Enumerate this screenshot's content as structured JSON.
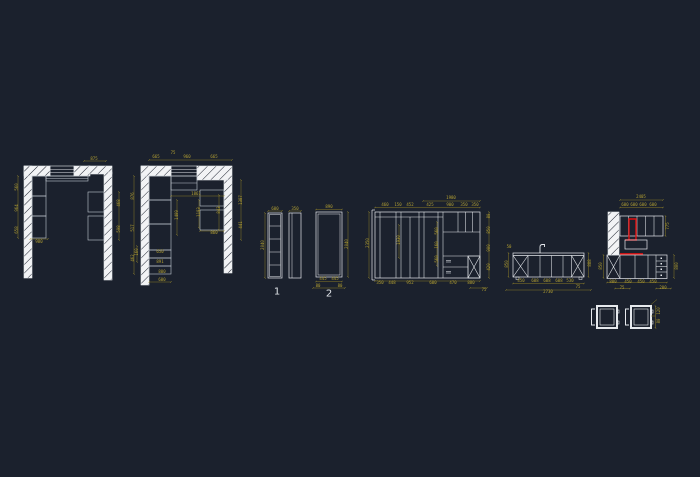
{
  "canvas": {
    "background": "#1b212d",
    "line_color": "#e6e9ed",
    "cabinet_line_color": "#c2c8d0",
    "dim_color": "#b3a032",
    "accent_red": "#e01010",
    "wall_fill": "#f2f3f5"
  },
  "view_labels": {
    "elevation_1": "1",
    "elevation_2": "2"
  },
  "dimensions": [
    {
      "x": 94,
      "y": 159,
      "t": "875"
    },
    {
      "x": 17,
      "y": 187,
      "t": "560",
      "r": -90
    },
    {
      "x": 17,
      "y": 208,
      "t": "964",
      "r": -90
    },
    {
      "x": 17,
      "y": 230,
      "t": "658",
      "r": -90
    },
    {
      "x": 39,
      "y": 242,
      "t": "980"
    },
    {
      "x": 119,
      "y": 203,
      "t": "468",
      "r": -90
    },
    {
      "x": 119,
      "y": 229,
      "t": "598",
      "r": -90
    },
    {
      "x": 156,
      "y": 157,
      "t": "665"
    },
    {
      "x": 173,
      "y": 153,
      "t": "75"
    },
    {
      "x": 187,
      "y": 157,
      "t": "960"
    },
    {
      "x": 214,
      "y": 157,
      "t": "665"
    },
    {
      "x": 133,
      "y": 196,
      "t": "876",
      "r": -90
    },
    {
      "x": 133,
      "y": 228,
      "t": "517",
      "r": -90
    },
    {
      "x": 133,
      "y": 258,
      "t": "462",
      "r": -90
    },
    {
      "x": 196,
      "y": 194,
      "t": "1861"
    },
    {
      "x": 177,
      "y": 215,
      "t": "1409",
      "r": -90
    },
    {
      "x": 199,
      "y": 212,
      "t": "1193",
      "r": -90
    },
    {
      "x": 219,
      "y": 210,
      "t": "843",
      "r": -90
    },
    {
      "x": 241,
      "y": 200,
      "t": "1387",
      "r": -90
    },
    {
      "x": 241,
      "y": 225,
      "t": "441",
      "r": -90
    },
    {
      "x": 214,
      "y": 233,
      "t": "860"
    },
    {
      "x": 160,
      "y": 252,
      "t": "650"
    },
    {
      "x": 160,
      "y": 262,
      "t": "891"
    },
    {
      "x": 162,
      "y": 272,
      "t": "800"
    },
    {
      "x": 162,
      "y": 280,
      "t": "600"
    },
    {
      "x": 137,
      "y": 252,
      "t": "160",
      "r": -90
    },
    {
      "x": 275,
      "y": 209,
      "t": "600"
    },
    {
      "x": 295,
      "y": 209,
      "t": "350"
    },
    {
      "x": 263,
      "y": 245,
      "t": "2040",
      "r": -90
    },
    {
      "x": 329,
      "y": 207,
      "t": "890"
    },
    {
      "x": 347,
      "y": 244,
      "t": "2040",
      "r": -90
    },
    {
      "x": 323,
      "y": 279,
      "t": "445"
    },
    {
      "x": 335,
      "y": 279,
      "t": "445"
    },
    {
      "x": 318,
      "y": 286,
      "t": "80"
    },
    {
      "x": 340,
      "y": 286,
      "t": "80"
    },
    {
      "x": 451,
      "y": 198,
      "t": "1980"
    },
    {
      "x": 385,
      "y": 205,
      "t": "460"
    },
    {
      "x": 398,
      "y": 205,
      "t": "150"
    },
    {
      "x": 410,
      "y": 205,
      "t": "452"
    },
    {
      "x": 430,
      "y": 205,
      "t": "425"
    },
    {
      "x": 450,
      "y": 205,
      "t": "900"
    },
    {
      "x": 464,
      "y": 205,
      "t": "350"
    },
    {
      "x": 475,
      "y": 205,
      "t": "350"
    },
    {
      "x": 368,
      "y": 243,
      "t": "2350",
      "r": -90
    },
    {
      "x": 399,
      "y": 240,
      "t": "1930",
      "r": -90
    },
    {
      "x": 437,
      "y": 231,
      "t": "560",
      "r": -90
    },
    {
      "x": 437,
      "y": 245,
      "t": "160",
      "r": -90
    },
    {
      "x": 437,
      "y": 259,
      "t": "560",
      "r": -90
    },
    {
      "x": 489,
      "y": 216,
      "t": "80",
      "r": -90
    },
    {
      "x": 489,
      "y": 230,
      "t": "850",
      "r": -90
    },
    {
      "x": 489,
      "y": 248,
      "t": "900",
      "r": -90
    },
    {
      "x": 489,
      "y": 267,
      "t": "420",
      "r": -90
    },
    {
      "x": 380,
      "y": 283,
      "t": "350"
    },
    {
      "x": 392,
      "y": 283,
      "t": "448"
    },
    {
      "x": 410,
      "y": 283,
      "t": "952"
    },
    {
      "x": 433,
      "y": 283,
      "t": "600"
    },
    {
      "x": 453,
      "y": 283,
      "t": "470"
    },
    {
      "x": 471,
      "y": 283,
      "t": "880"
    },
    {
      "x": 484,
      "y": 290,
      "t": "75"
    },
    {
      "x": 509,
      "y": 247,
      "t": "50"
    },
    {
      "x": 507,
      "y": 264,
      "t": "850",
      "r": -90
    },
    {
      "x": 590,
      "y": 263,
      "t": "888",
      "r": -90
    },
    {
      "x": 521,
      "y": 281,
      "t": "450"
    },
    {
      "x": 535,
      "y": 281,
      "t": "608"
    },
    {
      "x": 547,
      "y": 281,
      "t": "608"
    },
    {
      "x": 559,
      "y": 281,
      "t": "608"
    },
    {
      "x": 570,
      "y": 281,
      "t": "530"
    },
    {
      "x": 578,
      "y": 287,
      "t": "75"
    },
    {
      "x": 548,
      "y": 292,
      "t": "2730"
    },
    {
      "x": 641,
      "y": 197,
      "t": "2405"
    },
    {
      "x": 625,
      "y": 205,
      "t": "600"
    },
    {
      "x": 634,
      "y": 205,
      "t": "600"
    },
    {
      "x": 643,
      "y": 205,
      "t": "600"
    },
    {
      "x": 653,
      "y": 205,
      "t": "600"
    },
    {
      "x": 668,
      "y": 226,
      "t": "775",
      "r": -90
    },
    {
      "x": 677,
      "y": 266,
      "t": "800",
      "r": -90
    },
    {
      "x": 601,
      "y": 266,
      "t": "850",
      "r": -90
    },
    {
      "x": 613,
      "y": 282,
      "t": "800"
    },
    {
      "x": 628,
      "y": 282,
      "t": "450"
    },
    {
      "x": 641,
      "y": 282,
      "t": "450"
    },
    {
      "x": 653,
      "y": 282,
      "t": "450"
    },
    {
      "x": 663,
      "y": 288,
      "t": "200"
    },
    {
      "x": 622,
      "y": 288,
      "t": "75"
    },
    {
      "x": 659,
      "y": 311,
      "t": "120",
      "r": -90
    },
    {
      "x": 659,
      "y": 321,
      "t": "80",
      "r": -90
    }
  ]
}
